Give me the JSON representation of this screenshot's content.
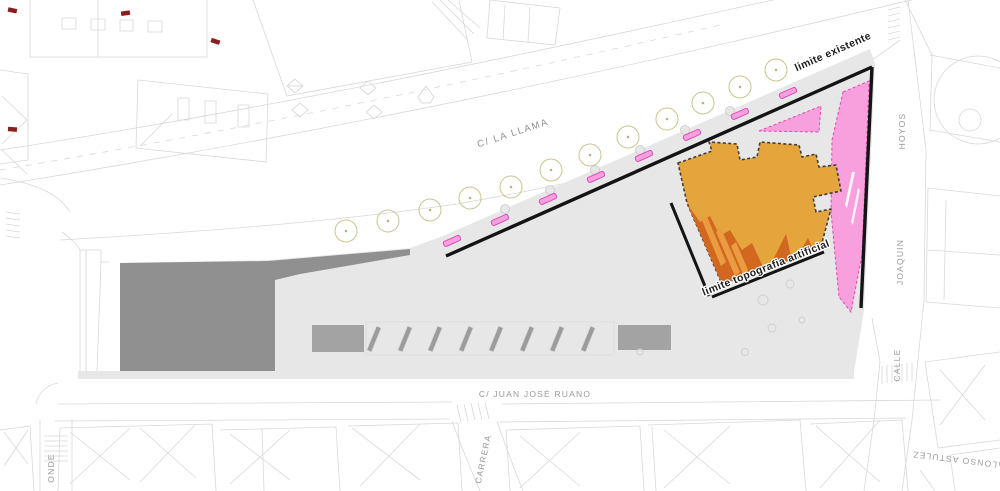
{
  "plan": {
    "streets": {
      "la_llama": "C/ LA LLAMA",
      "juan_jose_ruano": "C/ JUAN JOSÉ RUANO",
      "carrera": "CARRERA",
      "hoyos": "HOYOS",
      "joaquin": "JOAQUIN",
      "calle": "CALLE",
      "alonso_astulez": "ALONSO ASTULEZ",
      "onde": "ONDE"
    },
    "annotations": {
      "limite_existente": "limite existente",
      "limite_topografia": "limite topografia artificial"
    },
    "colors": {
      "plaza": "#e7e7e7",
      "platform_dark": "#909090",
      "furniture": "#a3a3a3",
      "building": "#E4A53C",
      "building_dark": "#D2671F",
      "building_stripe": "#EA9C40",
      "pink_fill": "#F8A0DD",
      "pink_border": "#E348B6",
      "boundary_black": "#141414",
      "tree_ring": "#CBC591",
      "linework": "#d8d8d8",
      "label_gray": "#8f8f8f",
      "red_mark": "#8A1F1F"
    }
  }
}
